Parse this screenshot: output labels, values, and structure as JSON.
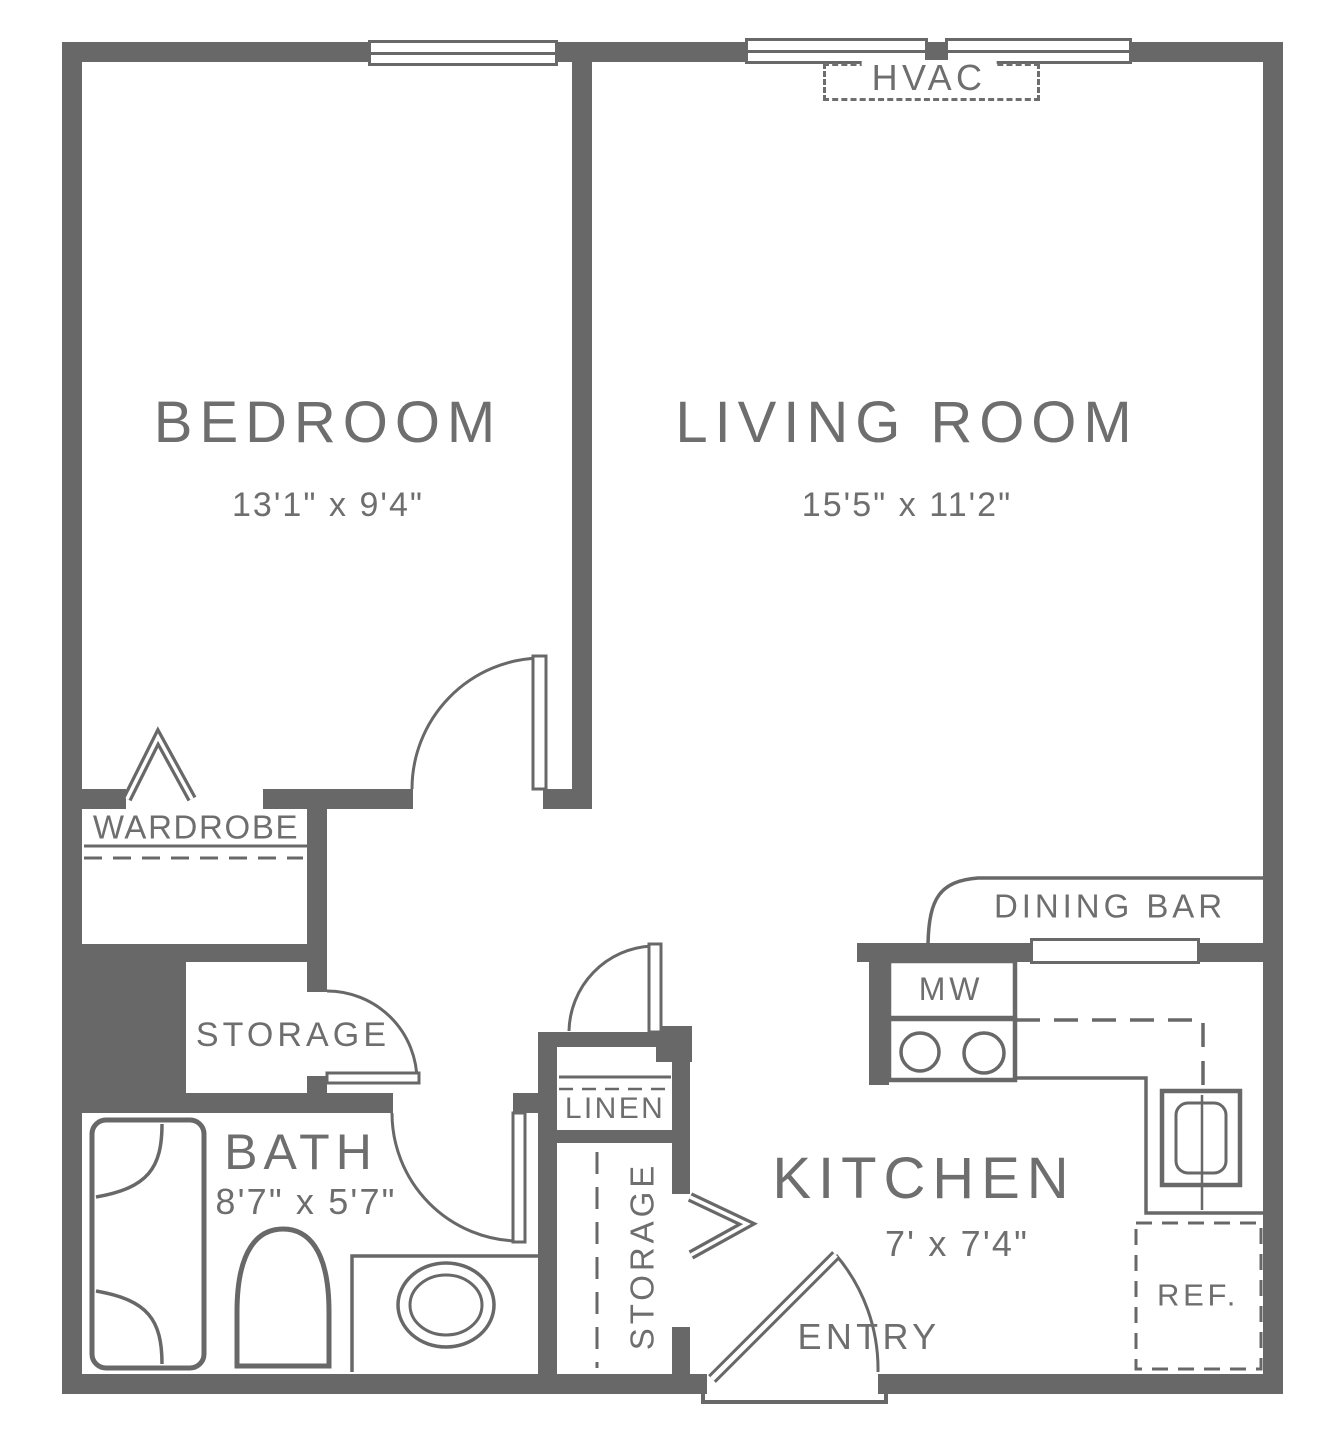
{
  "colors": {
    "wall": "#686868",
    "text": "#6e6e6e",
    "background": "#ffffff"
  },
  "rooms": {
    "bedroom": {
      "name": "BEDROOM",
      "dims": "13'1\" x 9'4\""
    },
    "living_room": {
      "name": "LIVING ROOM",
      "dims": "15'5\" x 11'2\""
    },
    "bath": {
      "name": "BATH",
      "dims": "8'7\" x 5'7\""
    },
    "kitchen": {
      "name": "KITCHEN",
      "dims": "7' x 7'4\""
    }
  },
  "features": {
    "hvac": "HVAC",
    "wardrobe": "WARDROBE",
    "hall_storage": "STORAGE",
    "linen": "LINEN",
    "tall_storage": "STORAGE",
    "dining_bar": "DINING BAR",
    "microwave": "MW",
    "refrigerator": "REF.",
    "entry": "ENTRY"
  }
}
